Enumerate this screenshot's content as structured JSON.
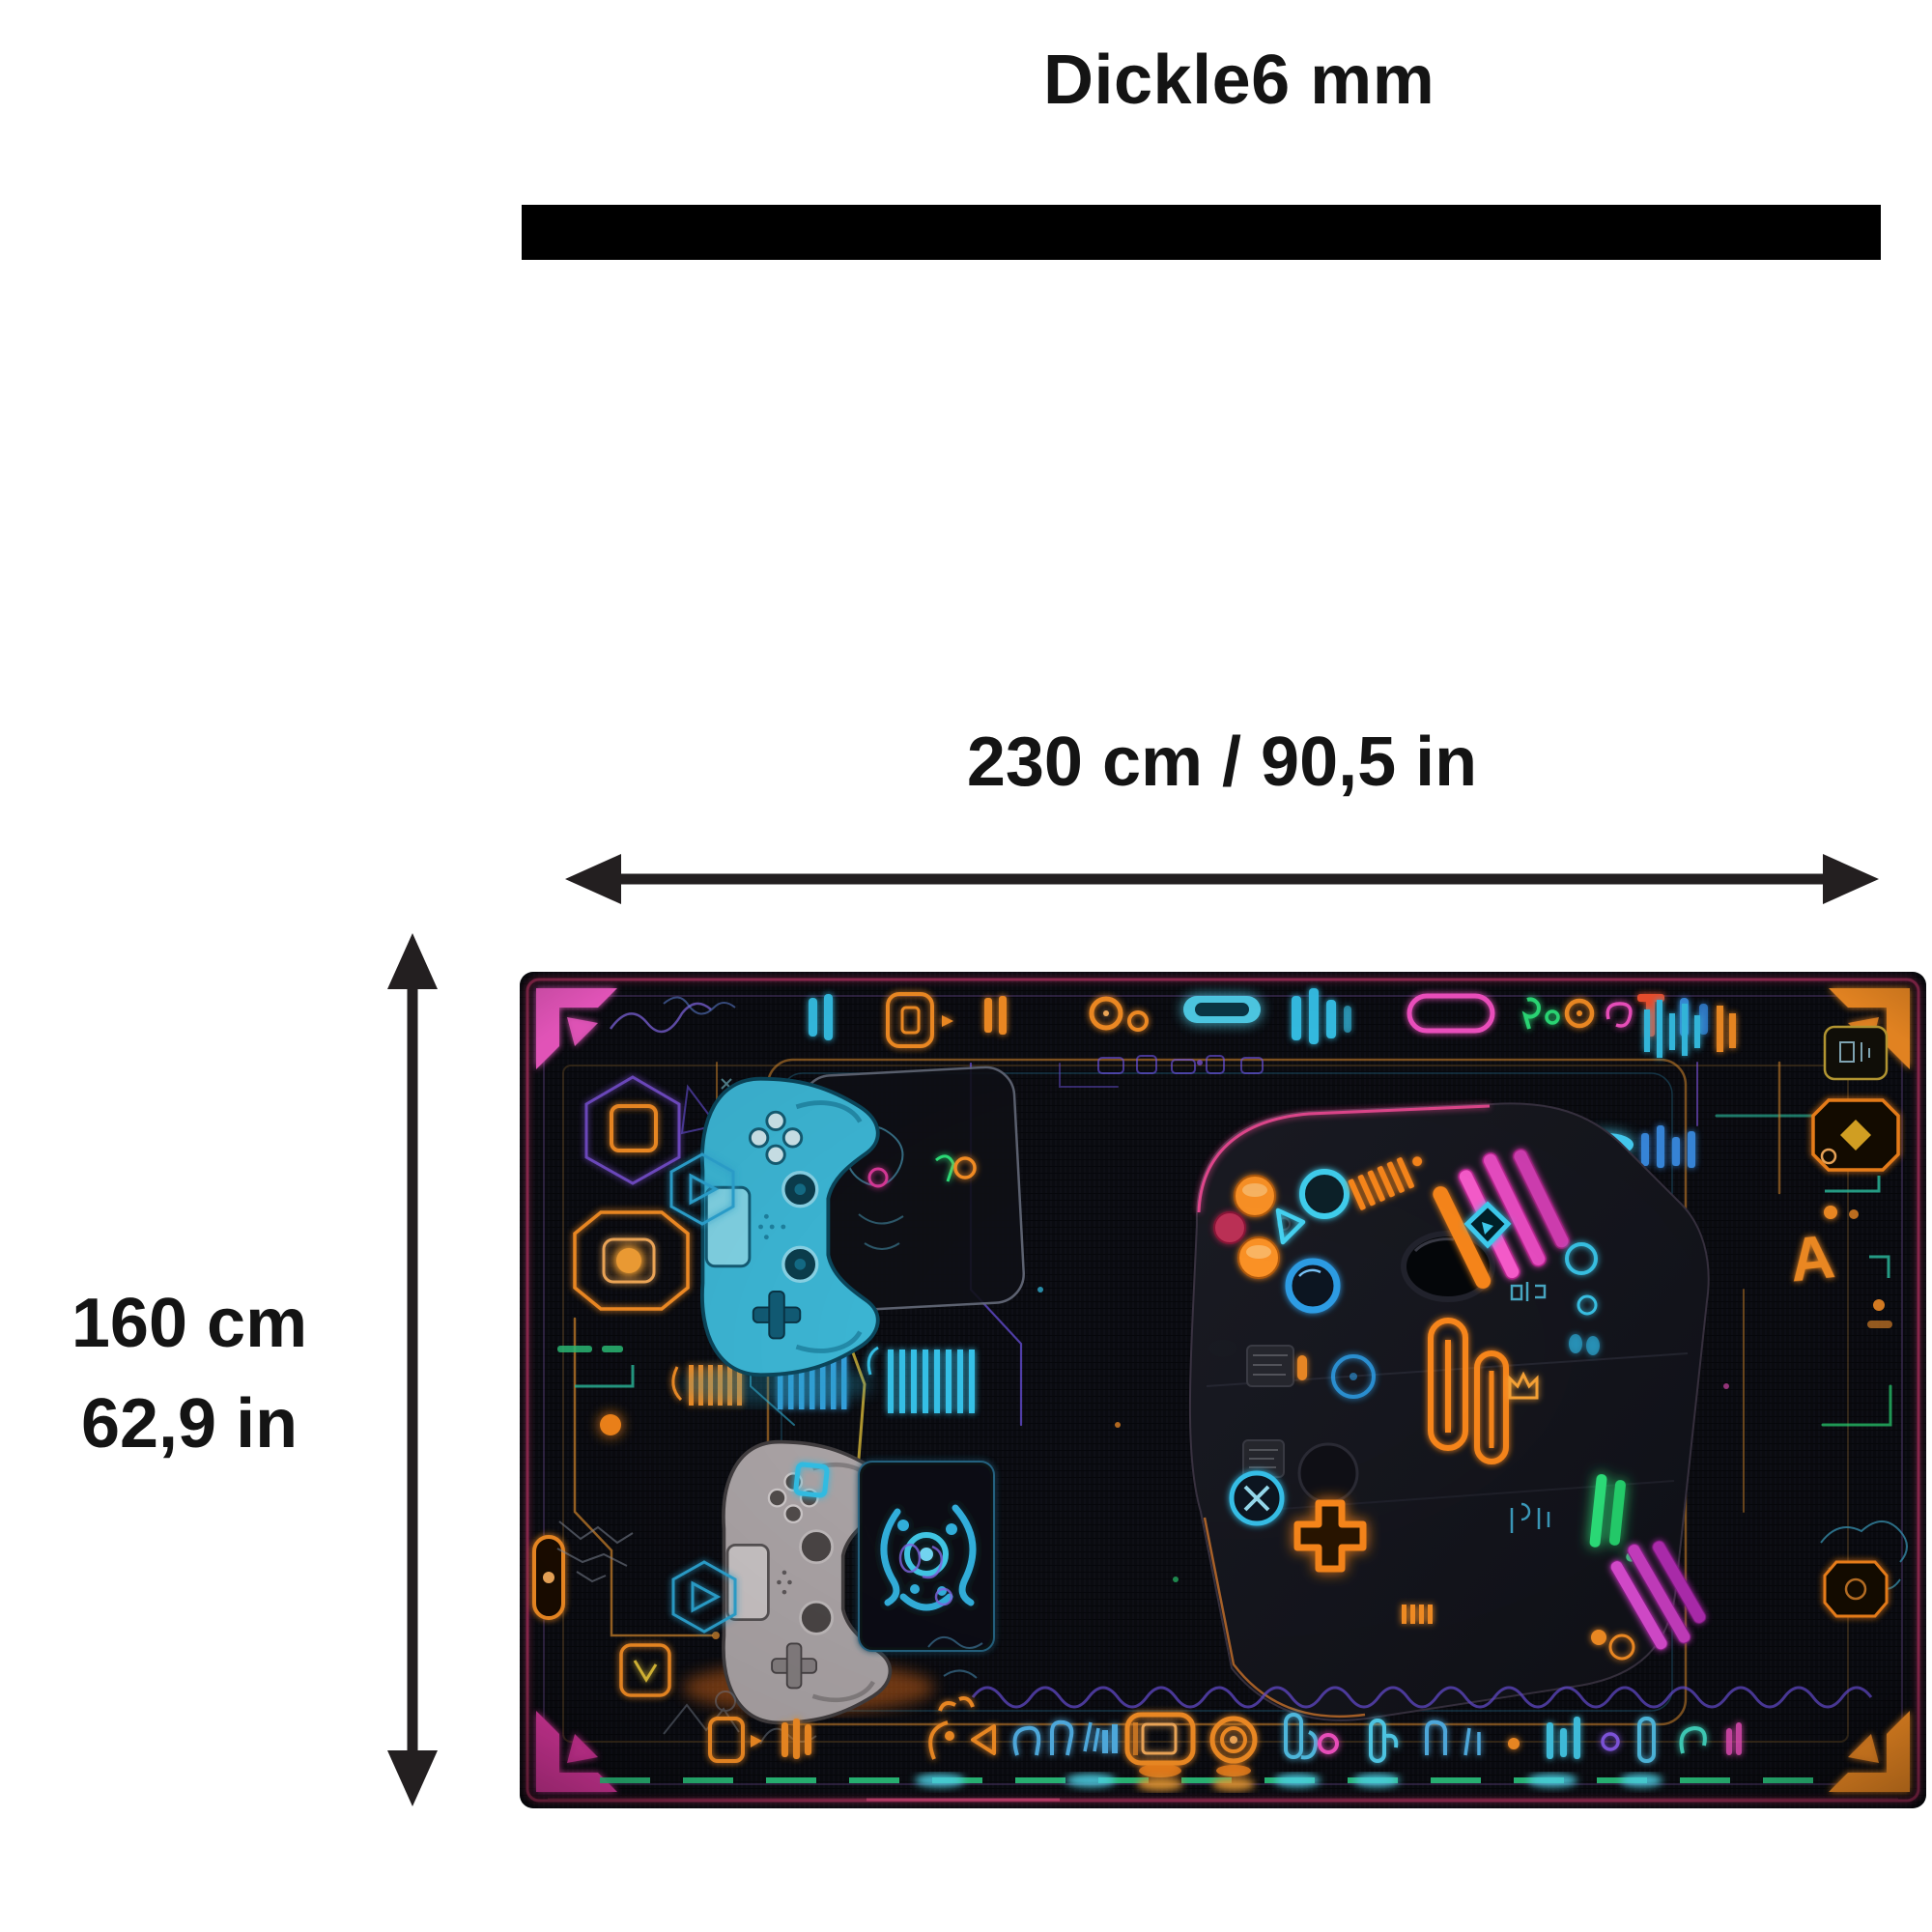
{
  "title": "Dickle6 mm",
  "dimensions": {
    "width": "230 cm / 90,5 in",
    "height_cm": "160 cm",
    "height_in": "62,9 in"
  },
  "rug": {
    "description": "Black gaming rug with neon circuit pattern, two PlayStation-style controllers and a large dark gamepad with glowing buttons",
    "letter_a": "A",
    "colors": {
      "text": "#141414",
      "arrow": "#231f20",
      "thickness_bar": "#000000",
      "rug_background": "#0b0c11",
      "neon_orange": "#ff8c1e",
      "neon_cyan": "#38c8f0",
      "neon_blue": "#2f8fe0",
      "neon_pink": "#ff55cc",
      "neon_magenta": "#e233a8",
      "neon_green": "#2ee87e",
      "neon_purple": "#7a5cff",
      "neon_yellow": "#e2bc3a",
      "controller_cyan": "#3fbede",
      "controller_gray": "#b3acae"
    }
  }
}
